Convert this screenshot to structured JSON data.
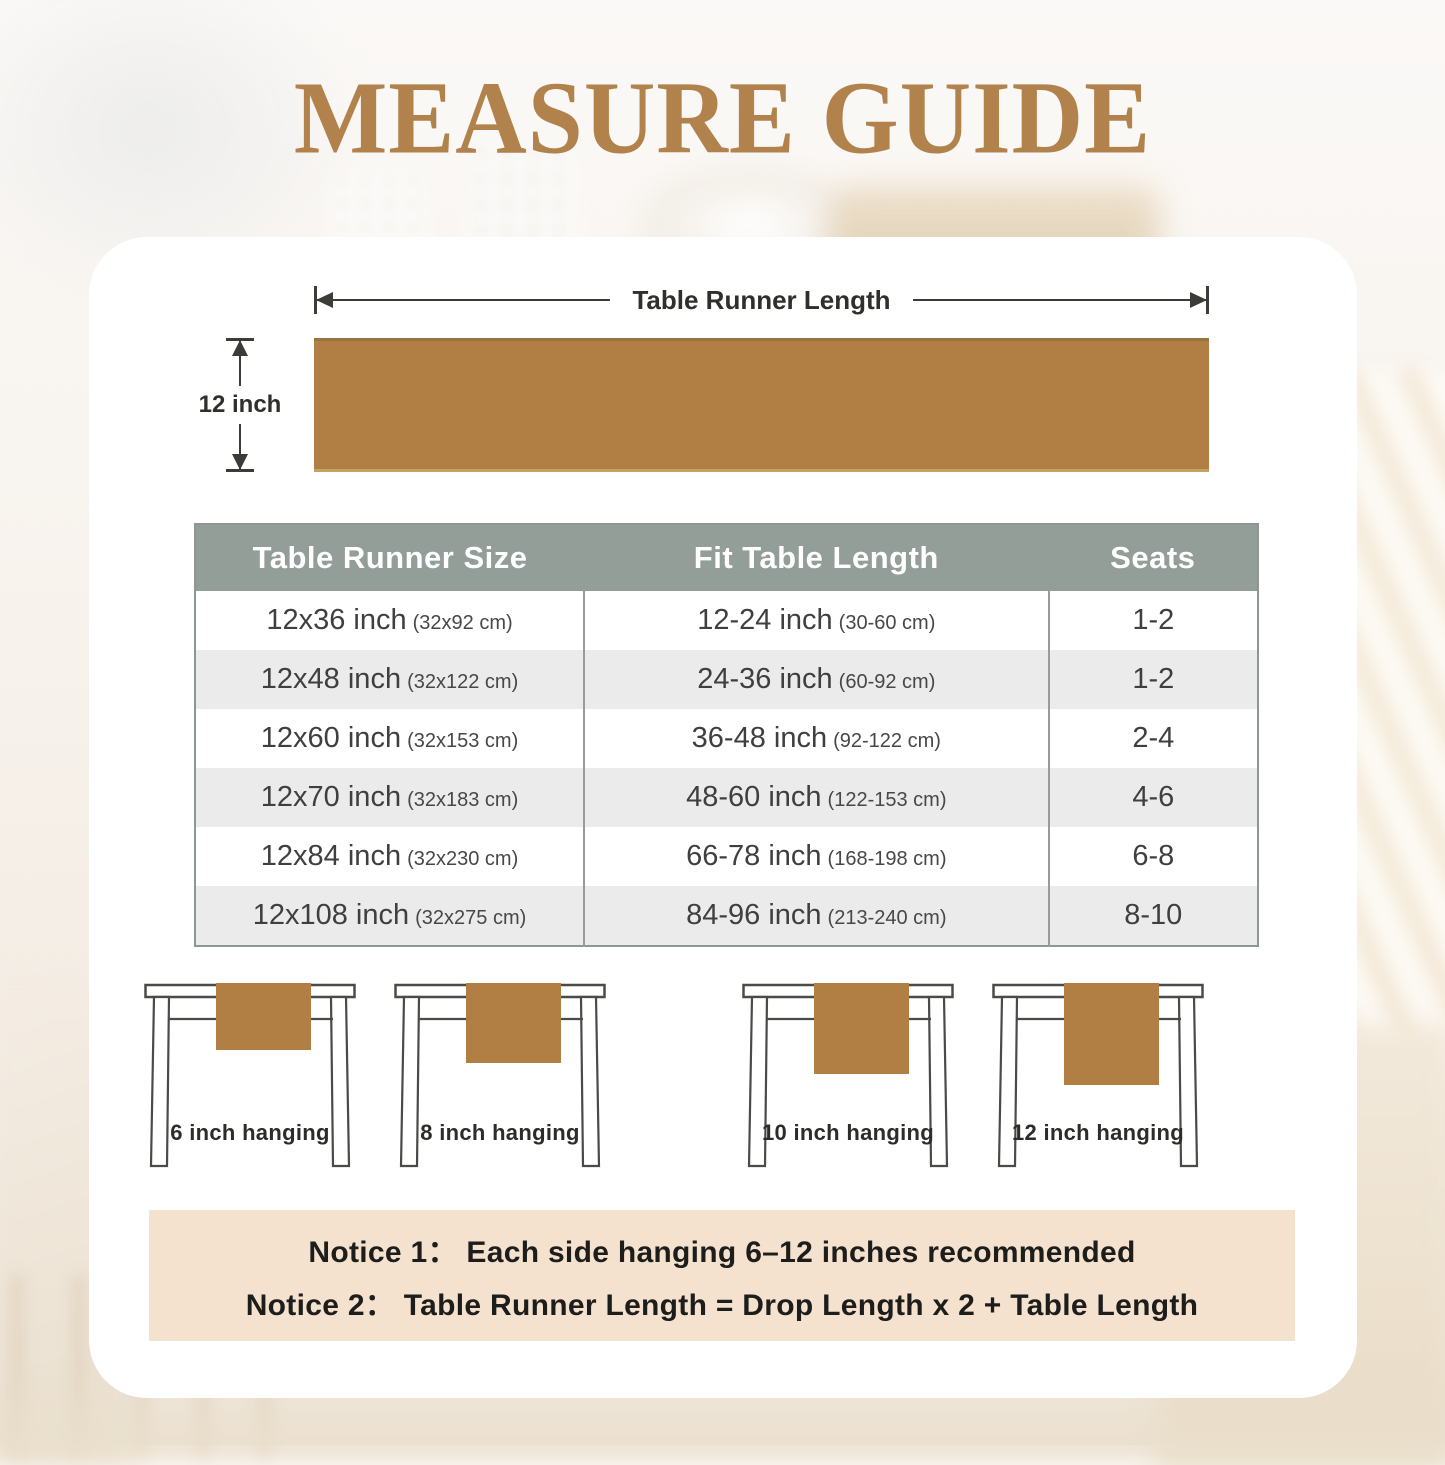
{
  "title": "MEASURE GUIDE",
  "diagram": {
    "length_label": "Table Runner Length",
    "width_label": "12 inch"
  },
  "size_table": {
    "headers": [
      "Table Runner Size",
      "Fit Table Length",
      "Seats"
    ],
    "rows": [
      {
        "size": "12x36 inch",
        "size_cm": "(32x92 cm)",
        "fit": "12-24 inch",
        "fit_cm": "(30-60 cm)",
        "seats": "1-2"
      },
      {
        "size": "12x48 inch",
        "size_cm": "(32x122 cm)",
        "fit": "24-36 inch",
        "fit_cm": "(60-92 cm)",
        "seats": "1-2"
      },
      {
        "size": "12x60 inch",
        "size_cm": "(32x153 cm)",
        "fit": "36-48 inch",
        "fit_cm": "(92-122 cm)",
        "seats": "2-4"
      },
      {
        "size": "12x70 inch",
        "size_cm": "(32x183 cm)",
        "fit": "48-60 inch",
        "fit_cm": "(122-153 cm)",
        "seats": "4-6"
      },
      {
        "size": "12x84 inch",
        "size_cm": "(32x230 cm)",
        "fit": "66-78 inch",
        "fit_cm": "(168-198 cm)",
        "seats": "6-8"
      },
      {
        "size": "12x108 inch",
        "size_cm": "(32x275 cm)",
        "fit": "84-96 inch",
        "fit_cm": "(213-240 cm)",
        "seats": "8-10"
      }
    ]
  },
  "hanging_figures": [
    {
      "label": "6 inch hanging",
      "runner_h": "67"
    },
    {
      "label": "8 inch hanging",
      "runner_h": "80"
    },
    {
      "label": "10 inch hanging",
      "runner_h": "91"
    },
    {
      "label": "12 inch hanging",
      "runner_h": "102"
    }
  ],
  "notices": {
    "line1": "Notice 1： Each side hanging 6–12 inches recommended",
    "line2": "Notice 2： Table Runner Length = Drop Length x 2 + Table Length"
  },
  "colors": {
    "accent_gold": "#b2824c",
    "runner_brown": "#b17e44",
    "table_header_bg": "#949e99",
    "row_alt_bg": "#ebebeb",
    "notice_bg": "#f4e2cf"
  }
}
